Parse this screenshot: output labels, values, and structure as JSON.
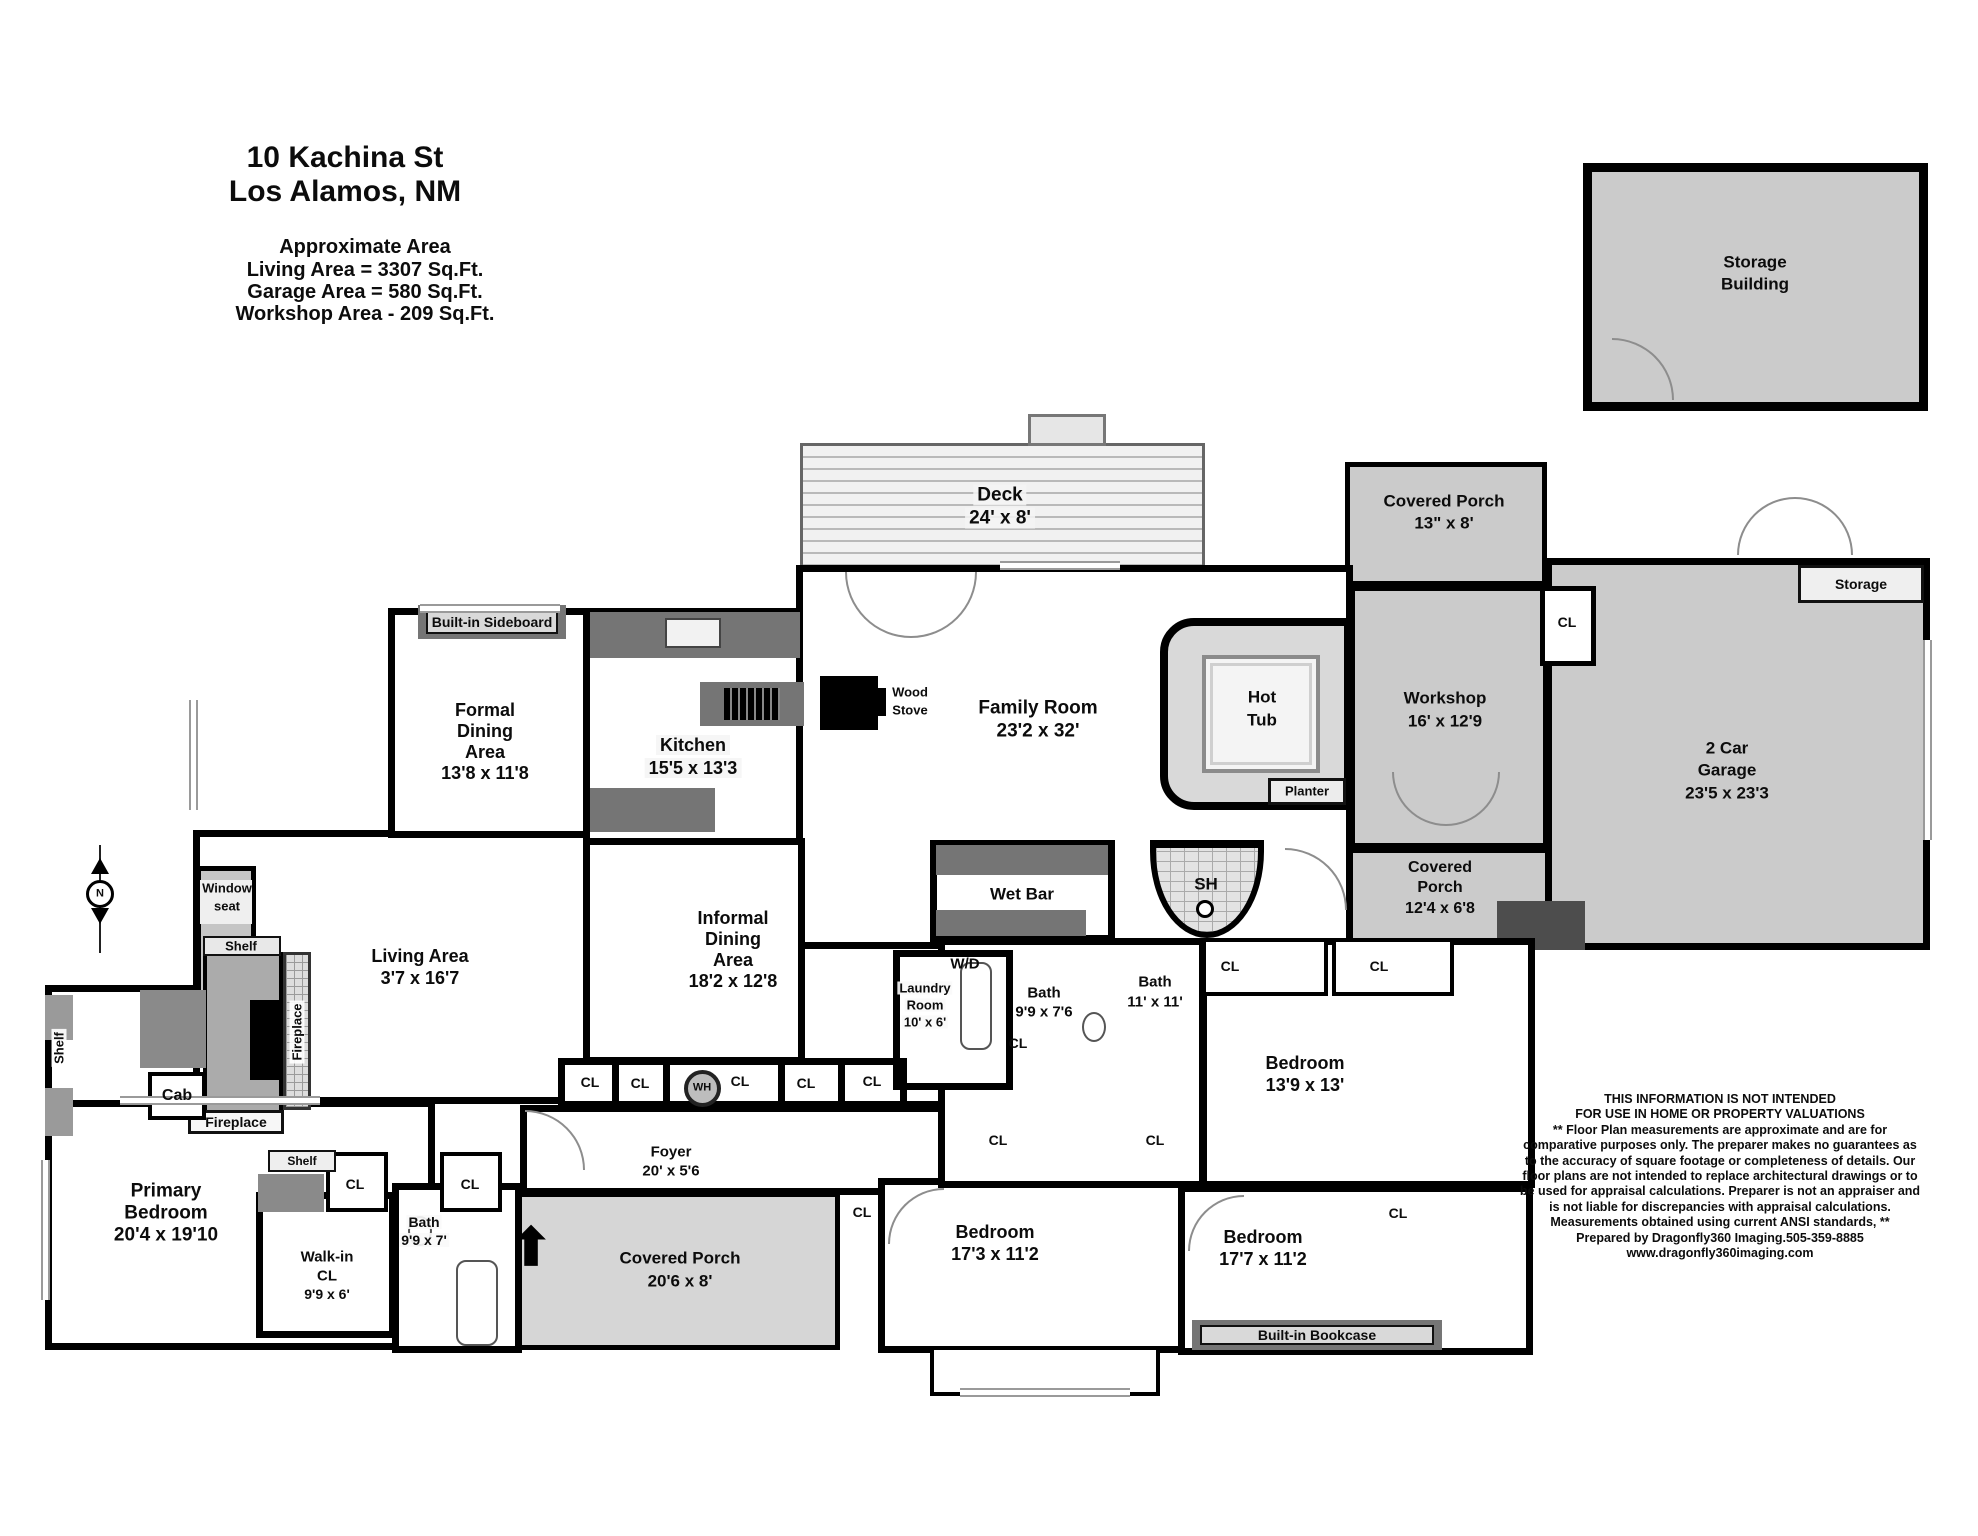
{
  "header": {
    "address_line1": "10 Kachina St",
    "address_line2": "Los Alamos, NM",
    "area_heading": "Approximate Area",
    "area_living": "Living Area = 3307 Sq.Ft.",
    "area_garage": "Garage Area = 580 Sq.Ft.",
    "area_workshop": "Workshop Area - 209 Sq.Ft."
  },
  "compass": {
    "label": "N"
  },
  "rooms": {
    "storage_building": {
      "line1": "Storage",
      "line2": "Building"
    },
    "deck": {
      "name": "Deck",
      "dims": "24' x 8'"
    },
    "covered_porch_top": {
      "name": "Covered Porch",
      "dims": "13\" x 8'"
    },
    "workshop": {
      "name": "Workshop",
      "dims": "16' x 12'9"
    },
    "garage": {
      "line1": "2 Car",
      "line2": "Garage",
      "dims": "23'5 x 23'3"
    },
    "garage_storage": {
      "name": "Storage"
    },
    "covered_porch_mid": {
      "line1": "Covered",
      "line2": "Porch",
      "dims": "12'4 x 6'8"
    },
    "hot_tub": {
      "line1": "Hot",
      "line2": "Tub"
    },
    "family_room": {
      "name": "Family Room",
      "dims": "23'2 x 32'"
    },
    "formal_dining": {
      "line1": "Formal",
      "line2": "Dining",
      "line3": "Area",
      "dims": "13'8 x 11'8"
    },
    "kitchen": {
      "name": "Kitchen",
      "dims": "15'5 x 13'3"
    },
    "living": {
      "name": "Living Area",
      "dims": "3'7 x 16'7"
    },
    "informal_dining": {
      "line1": "Informal",
      "line2": "Dining",
      "line3": "Area",
      "dims": "18'2 x 12'8"
    },
    "wet_bar": {
      "name": "Wet Bar"
    },
    "wd": {
      "name": "W/D"
    },
    "laundry": {
      "line1": "Laundry",
      "line2": "Room",
      "dims": "10' x 6'"
    },
    "bath_976": {
      "name": "Bath",
      "dims": "9'9 x 7'6"
    },
    "bath_1111": {
      "name": "Bath",
      "dims": "11' x 11'"
    },
    "shower": {
      "name": "SH"
    },
    "bedroom_139": {
      "name": "Bedroom",
      "dims": "13'9 x 13'"
    },
    "primary_bedroom": {
      "line1": "Primary",
      "line2": "Bedroom",
      "dims": "20'4 x 19'10"
    },
    "walkin_cl": {
      "line1": "Walk-in",
      "line2": "CL",
      "dims": "9'9 x 6'"
    },
    "bath_997": {
      "name": "Bath",
      "dims": "9'9 x 7'"
    },
    "foyer": {
      "name": "Foyer",
      "dims": "20' x 5'6"
    },
    "covered_porch_bottom": {
      "name": "Covered Porch",
      "dims": "20'6 x 8'"
    },
    "bedroom_173": {
      "name": "Bedroom",
      "dims": "17'3 x 11'2"
    },
    "bedroom_177": {
      "name": "Bedroom",
      "dims": "17'7 x 11'2"
    }
  },
  "features": {
    "built_in_sideboard": "Built-in Sideboard",
    "built_in_bookcase": "Built-in Bookcase",
    "wood_stove_line1": "Wood",
    "wood_stove_line2": "Stove",
    "window_seat_line1": "Window",
    "window_seat_line2": "seat",
    "planter": "Planter",
    "shelf": "Shelf",
    "fireplace": "Fireplace",
    "cab": "Cab",
    "wh": "WH",
    "cl": "CL"
  },
  "disclaimer": {
    "lines": [
      "THIS INFORMATION IS NOT INTENDED",
      "FOR USE IN HOME OR PROPERTY VALUATIONS",
      "** Floor Plan measurements are approximate and are for",
      "comparative purposes only. The preparer makes no guarantees as",
      "to the accuracy of square footage or completeness of details. Our",
      "floor plans are not intended to replace architectural drawings or to",
      "be used for appraisal calculations. Preparer is not an appraiser and",
      "is not liable for discrepancies with appraisal calculations.",
      "Measurements obtained using current ANSI standards, **",
      "Prepared by Dragonfly360 Imaging.505-359-8885",
      "www.dragonfly360imaging.com"
    ]
  },
  "colors": {
    "wall": "#000000",
    "outdoor": "#cbcbcb",
    "dark": "#757575",
    "paper": "#ffffff"
  }
}
